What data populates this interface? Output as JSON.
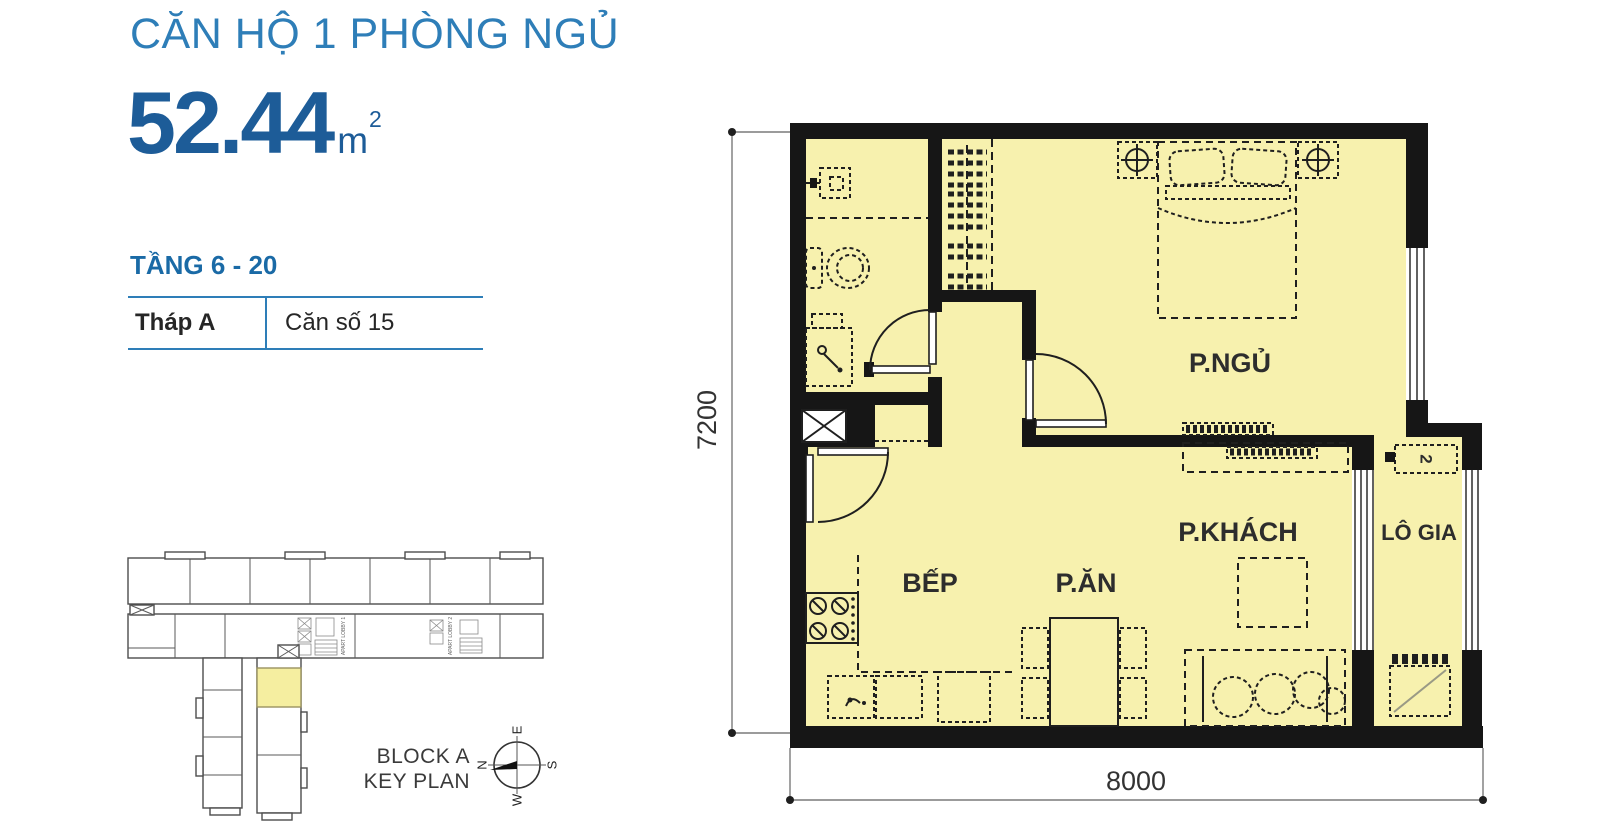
{
  "header": {
    "title": "CĂN HỘ 1 PHÒNG NGỦ",
    "area": {
      "value": "52.44",
      "unit": "m",
      "sup": "2"
    },
    "floor_range": "TẦNG 6 - 20",
    "table": {
      "tower": "Tháp A",
      "unit_no": "Căn số 15"
    }
  },
  "plan": {
    "labels": {
      "bedroom": "P.NGỦ",
      "living": "P.KHÁCH",
      "dining": "P.ĂN",
      "kitchen": "BẾP",
      "loggia": "LÔ GIA"
    },
    "dims": {
      "width": "8000",
      "height": "7200"
    },
    "loggia_tag": "2"
  },
  "keyplan": {
    "caption_line1": "BLOCK A",
    "caption_line2": "KEY PLAN",
    "lobby1": "APART LOBBY 1",
    "lobby2": "APART LOBBY 2",
    "compass": {
      "n": "N",
      "e": "E",
      "s": "S",
      "w": "W"
    }
  },
  "colors": {
    "title_blue": "#2E7EB8",
    "dark_blue": "#1D5C98",
    "floor_yellow": "#F7F1AE",
    "wall_black": "#161616",
    "keyplan_highlight": "#F5EEA0"
  }
}
